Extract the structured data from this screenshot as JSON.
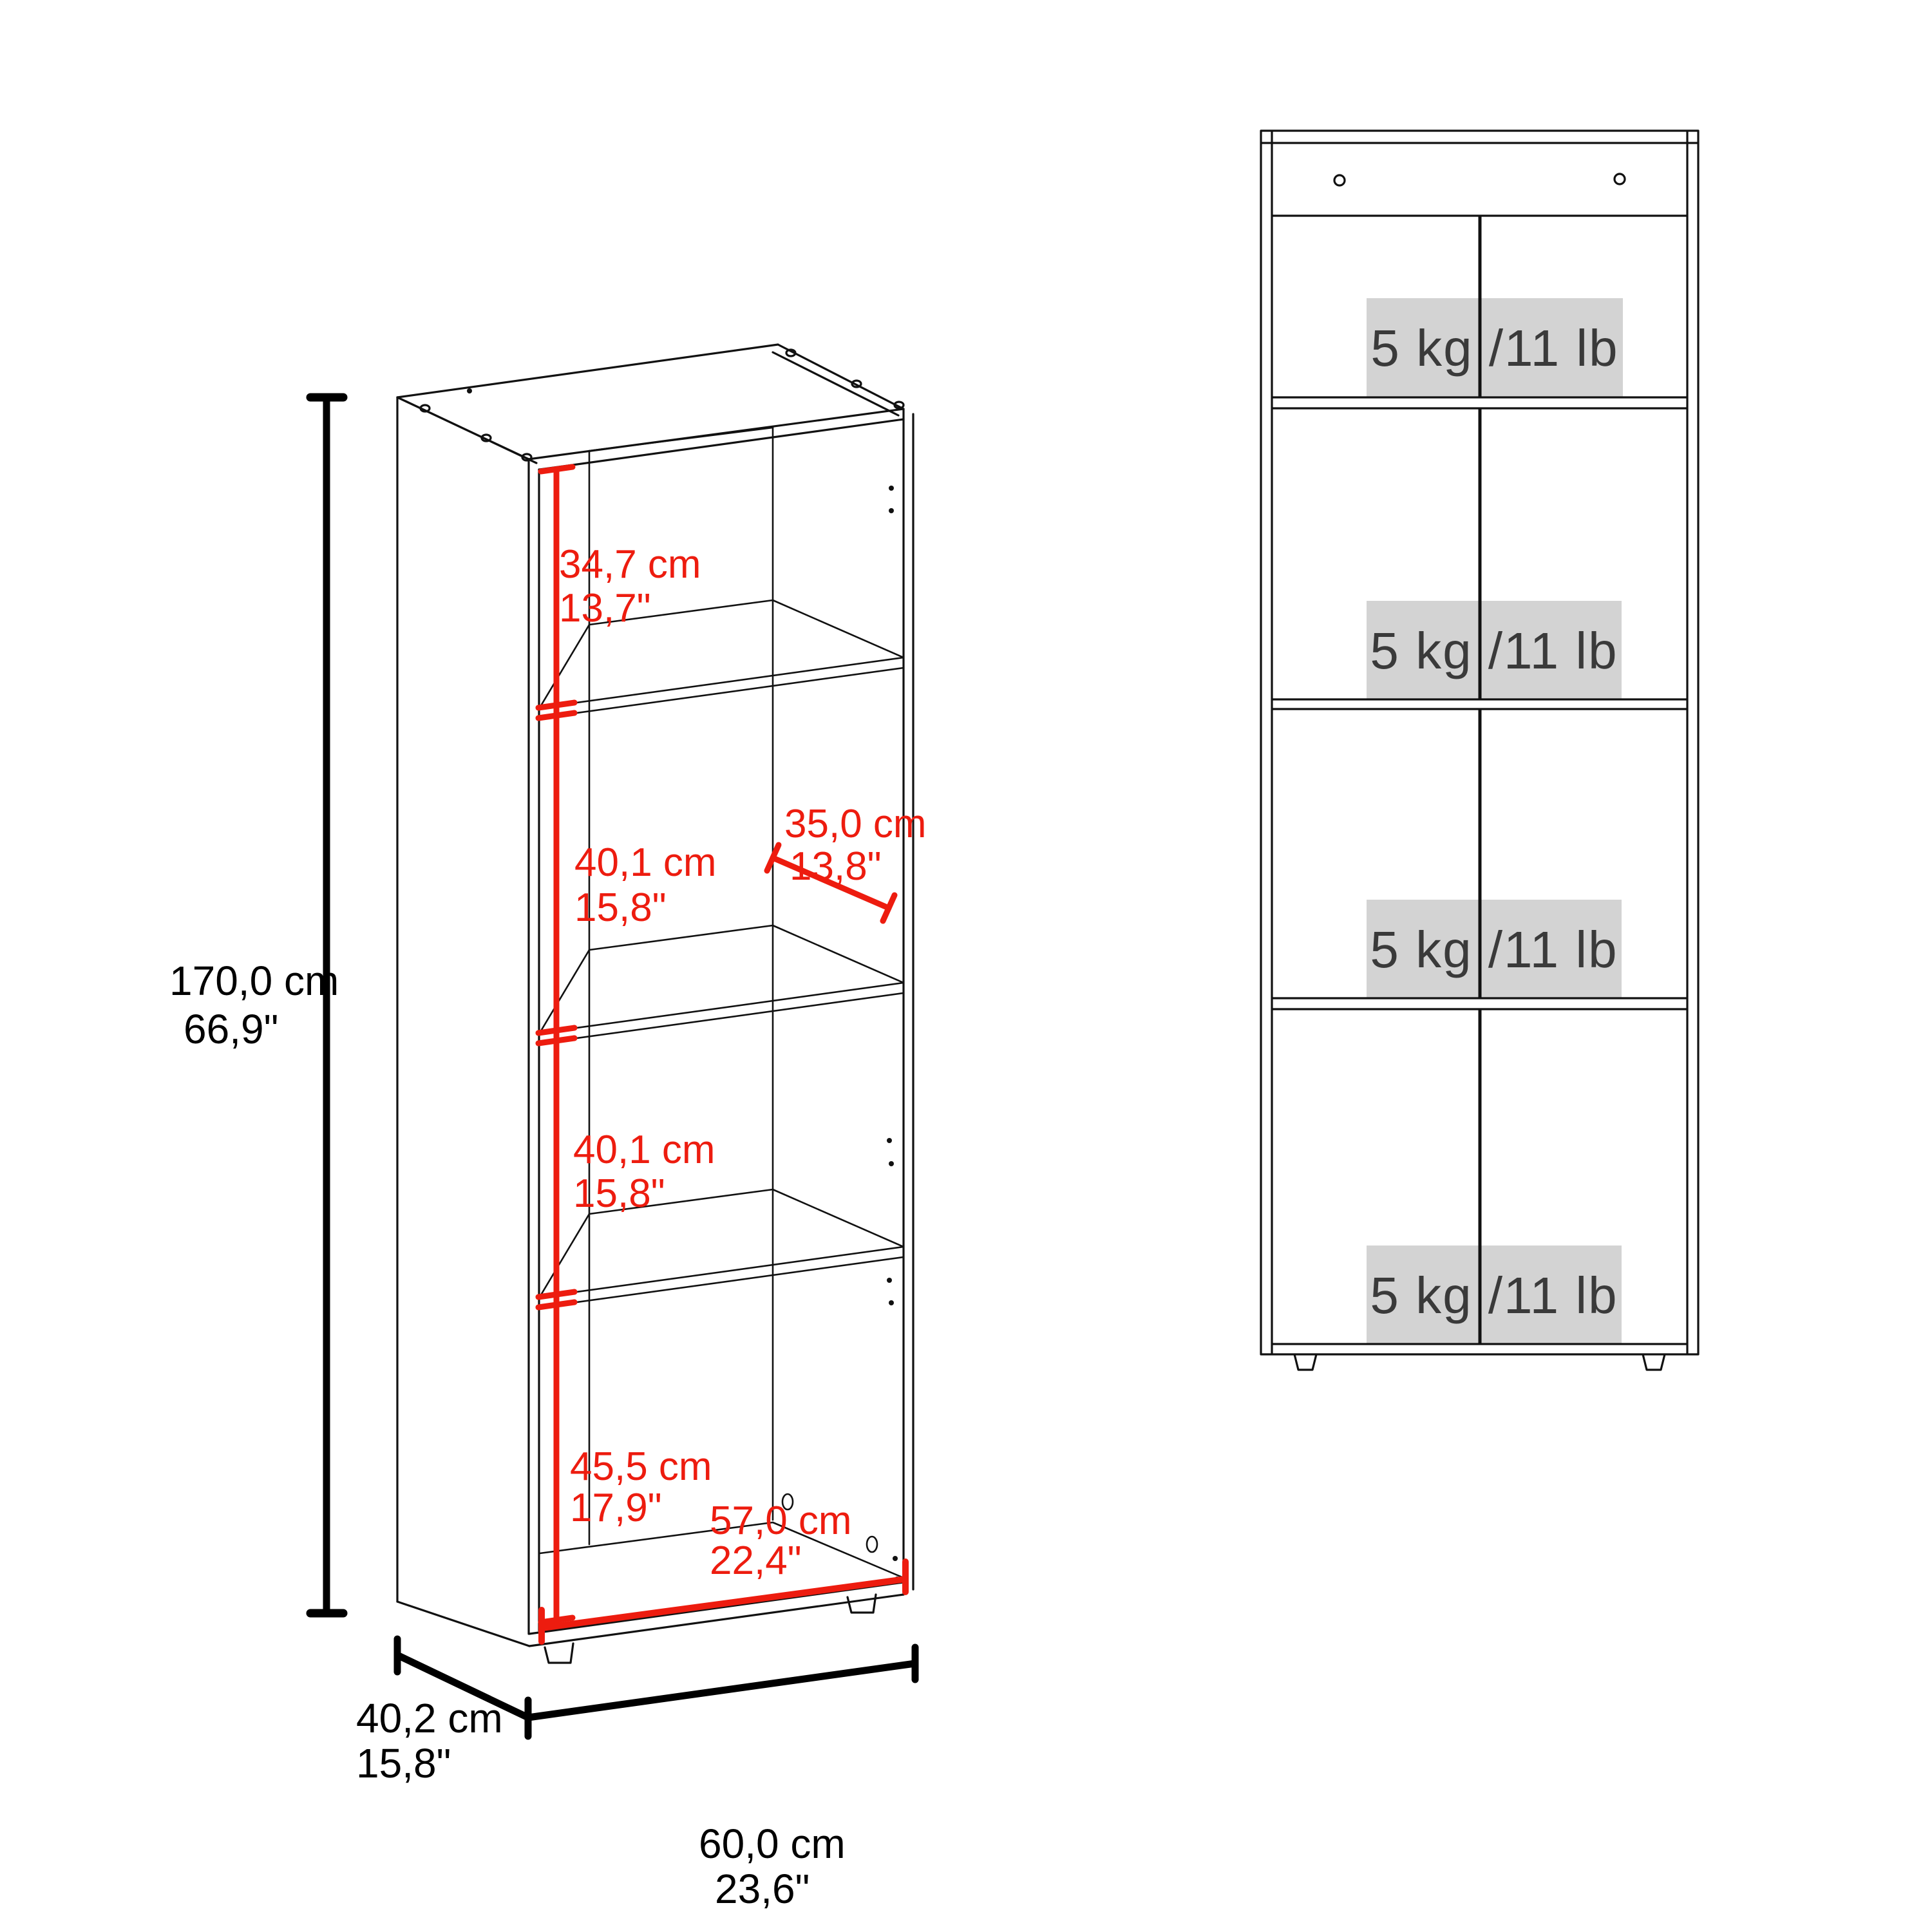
{
  "diagram_title": "bookcase dimension drawing",
  "colors": {
    "dimension_red": "#ed1c0f",
    "line_black": "#111111",
    "capacity_box_bg": "#d3d3d3",
    "capacity_text": "#3a3a3a",
    "background": "#ffffff"
  },
  "left_view": {
    "name": "isometric view with dimensions",
    "height": {
      "cm": "170,0 cm",
      "in": "66,9\""
    },
    "compartments": [
      {
        "cm": "34,7 cm",
        "in": "13,7\""
      },
      {
        "cm": "40,1 cm",
        "in": "15,8\""
      },
      {
        "cm": "40,1 cm",
        "in": "15,8\""
      },
      {
        "cm": "45,5 cm",
        "in": "17,9\""
      }
    ],
    "inner_depth": {
      "cm": "35,0 cm",
      "in": "13,8\""
    },
    "inner_width": {
      "cm": "57,0 cm",
      "in": "22,4\""
    },
    "base_depth": {
      "cm": "40,2 cm",
      "in": "15,8\""
    },
    "base_width": {
      "cm": "60,0 cm",
      "in": "23,6\""
    }
  },
  "front_view": {
    "name": "front elevation with shelf load ratings",
    "shelves": [
      {
        "label": "5 kg /11 lb"
      },
      {
        "label": "5 kg /11 lb"
      },
      {
        "label": "5 kg /11 lb"
      },
      {
        "label": "5 kg /11 lb"
      }
    ]
  }
}
